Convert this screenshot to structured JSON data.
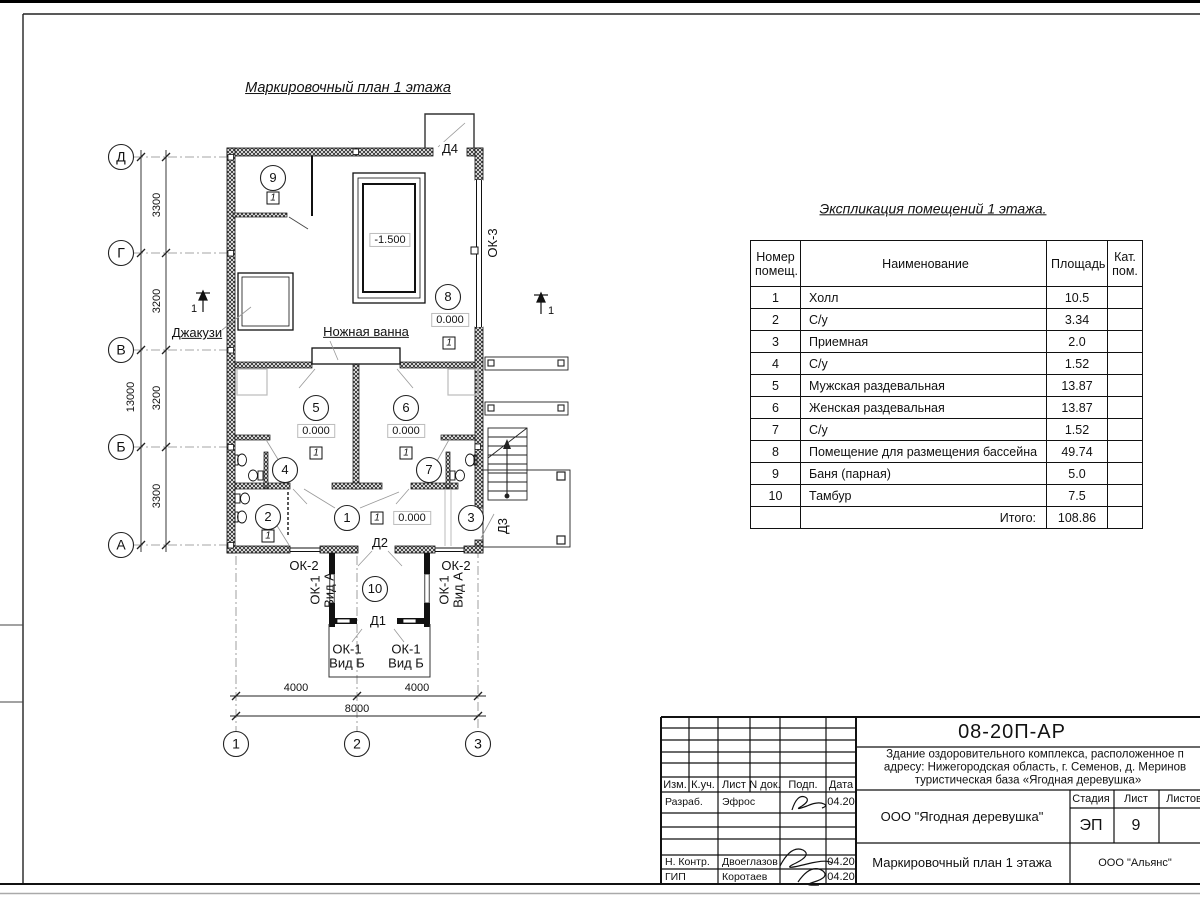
{
  "plan": {
    "title": "Маркировочный план 1 этажа",
    "axes_letters": [
      "Д",
      "Г",
      "В",
      "Б",
      "А"
    ],
    "axes_numbers": [
      "1",
      "2",
      "3"
    ],
    "dims_vertical": [
      "3300",
      "3200",
      "3200",
      "3300"
    ],
    "dim_total_vertical": "13000",
    "dims_horizontal": [
      "4000",
      "4000"
    ],
    "dim_total_horizontal": "8000",
    "rooms": [
      "1",
      "2",
      "3",
      "4",
      "5",
      "6",
      "7",
      "8",
      "9",
      "10"
    ],
    "type_marker": "1",
    "levels": {
      "zero": "0.000",
      "pool": "-1.500"
    },
    "labels": {
      "jacuzzi": "Джакузи",
      "foot_bath": "Ножная ванна"
    },
    "windows": {
      "ok1": "ОК-1",
      "ok2": "ОК-2",
      "ok3": "ОК-3"
    },
    "views": {
      "a": "Вид А",
      "b": "Вид Б"
    },
    "doors": {
      "d1": "Д1",
      "d2": "Д2",
      "d3": "Д3",
      "d4": "Д4"
    },
    "section_mark": "1"
  },
  "table": {
    "title": "Экспликация помещений 1 этажа.",
    "headers": {
      "num": "Номер\nпомещ.",
      "name": "Наименование",
      "area": "Площадь",
      "cat": "Кат.\nпом."
    },
    "rows": [
      {
        "num": "1",
        "name": "Холл",
        "area": "10.5"
      },
      {
        "num": "2",
        "name": "С/у",
        "area": "3.34"
      },
      {
        "num": "3",
        "name": "Приемная",
        "area": "2.0"
      },
      {
        "num": "4",
        "name": "С/у",
        "area": "1.52"
      },
      {
        "num": "5",
        "name": "Мужская раздевальная",
        "area": "13.87"
      },
      {
        "num": "6",
        "name": "Женская раздевальная",
        "area": "13.87"
      },
      {
        "num": "7",
        "name": "С/у",
        "area": "1.52"
      },
      {
        "num": "8",
        "name": "Помещение для размещения бассейна",
        "area": "49.74"
      },
      {
        "num": "9",
        "name": "Баня (парная)",
        "area": "5.0"
      },
      {
        "num": "10",
        "name": "Тамбур",
        "area": "7.5"
      }
    ],
    "total_label": "Итого:",
    "total_value": "108.86"
  },
  "titleblock": {
    "code": "08-20П-АР",
    "desc_line1": "Здание оздоровительного комплекса, расположенное п",
    "desc_line2": "адресу: Нижегородская область, г. Семенов, д. Меринов",
    "desc_line3": "туристическая база «Ягодная деревушка»",
    "org": "ООО \"Ягодная деревушка\"",
    "doc_title": "Маркировочный план 1 этажа",
    "contractor": "ООО \"Альянс\"",
    "stage_label": "Стадия",
    "sheet_label": "Лист",
    "sheets_label": "Листов",
    "stage_value": "ЭП",
    "sheet_value": "9",
    "columns": [
      "Изм.",
      "К.уч.",
      "Лист",
      "N док.",
      "Подп.",
      "Дата"
    ],
    "people": [
      {
        "role": "Разраб.",
        "name": "Эфрос",
        "date": "04.20"
      },
      {
        "role": "Н. Контр.",
        "name": "Двоеглазов",
        "date": "04.20"
      },
      {
        "role": "ГИП",
        "name": "Коротаев",
        "date": "04.20"
      }
    ]
  }
}
